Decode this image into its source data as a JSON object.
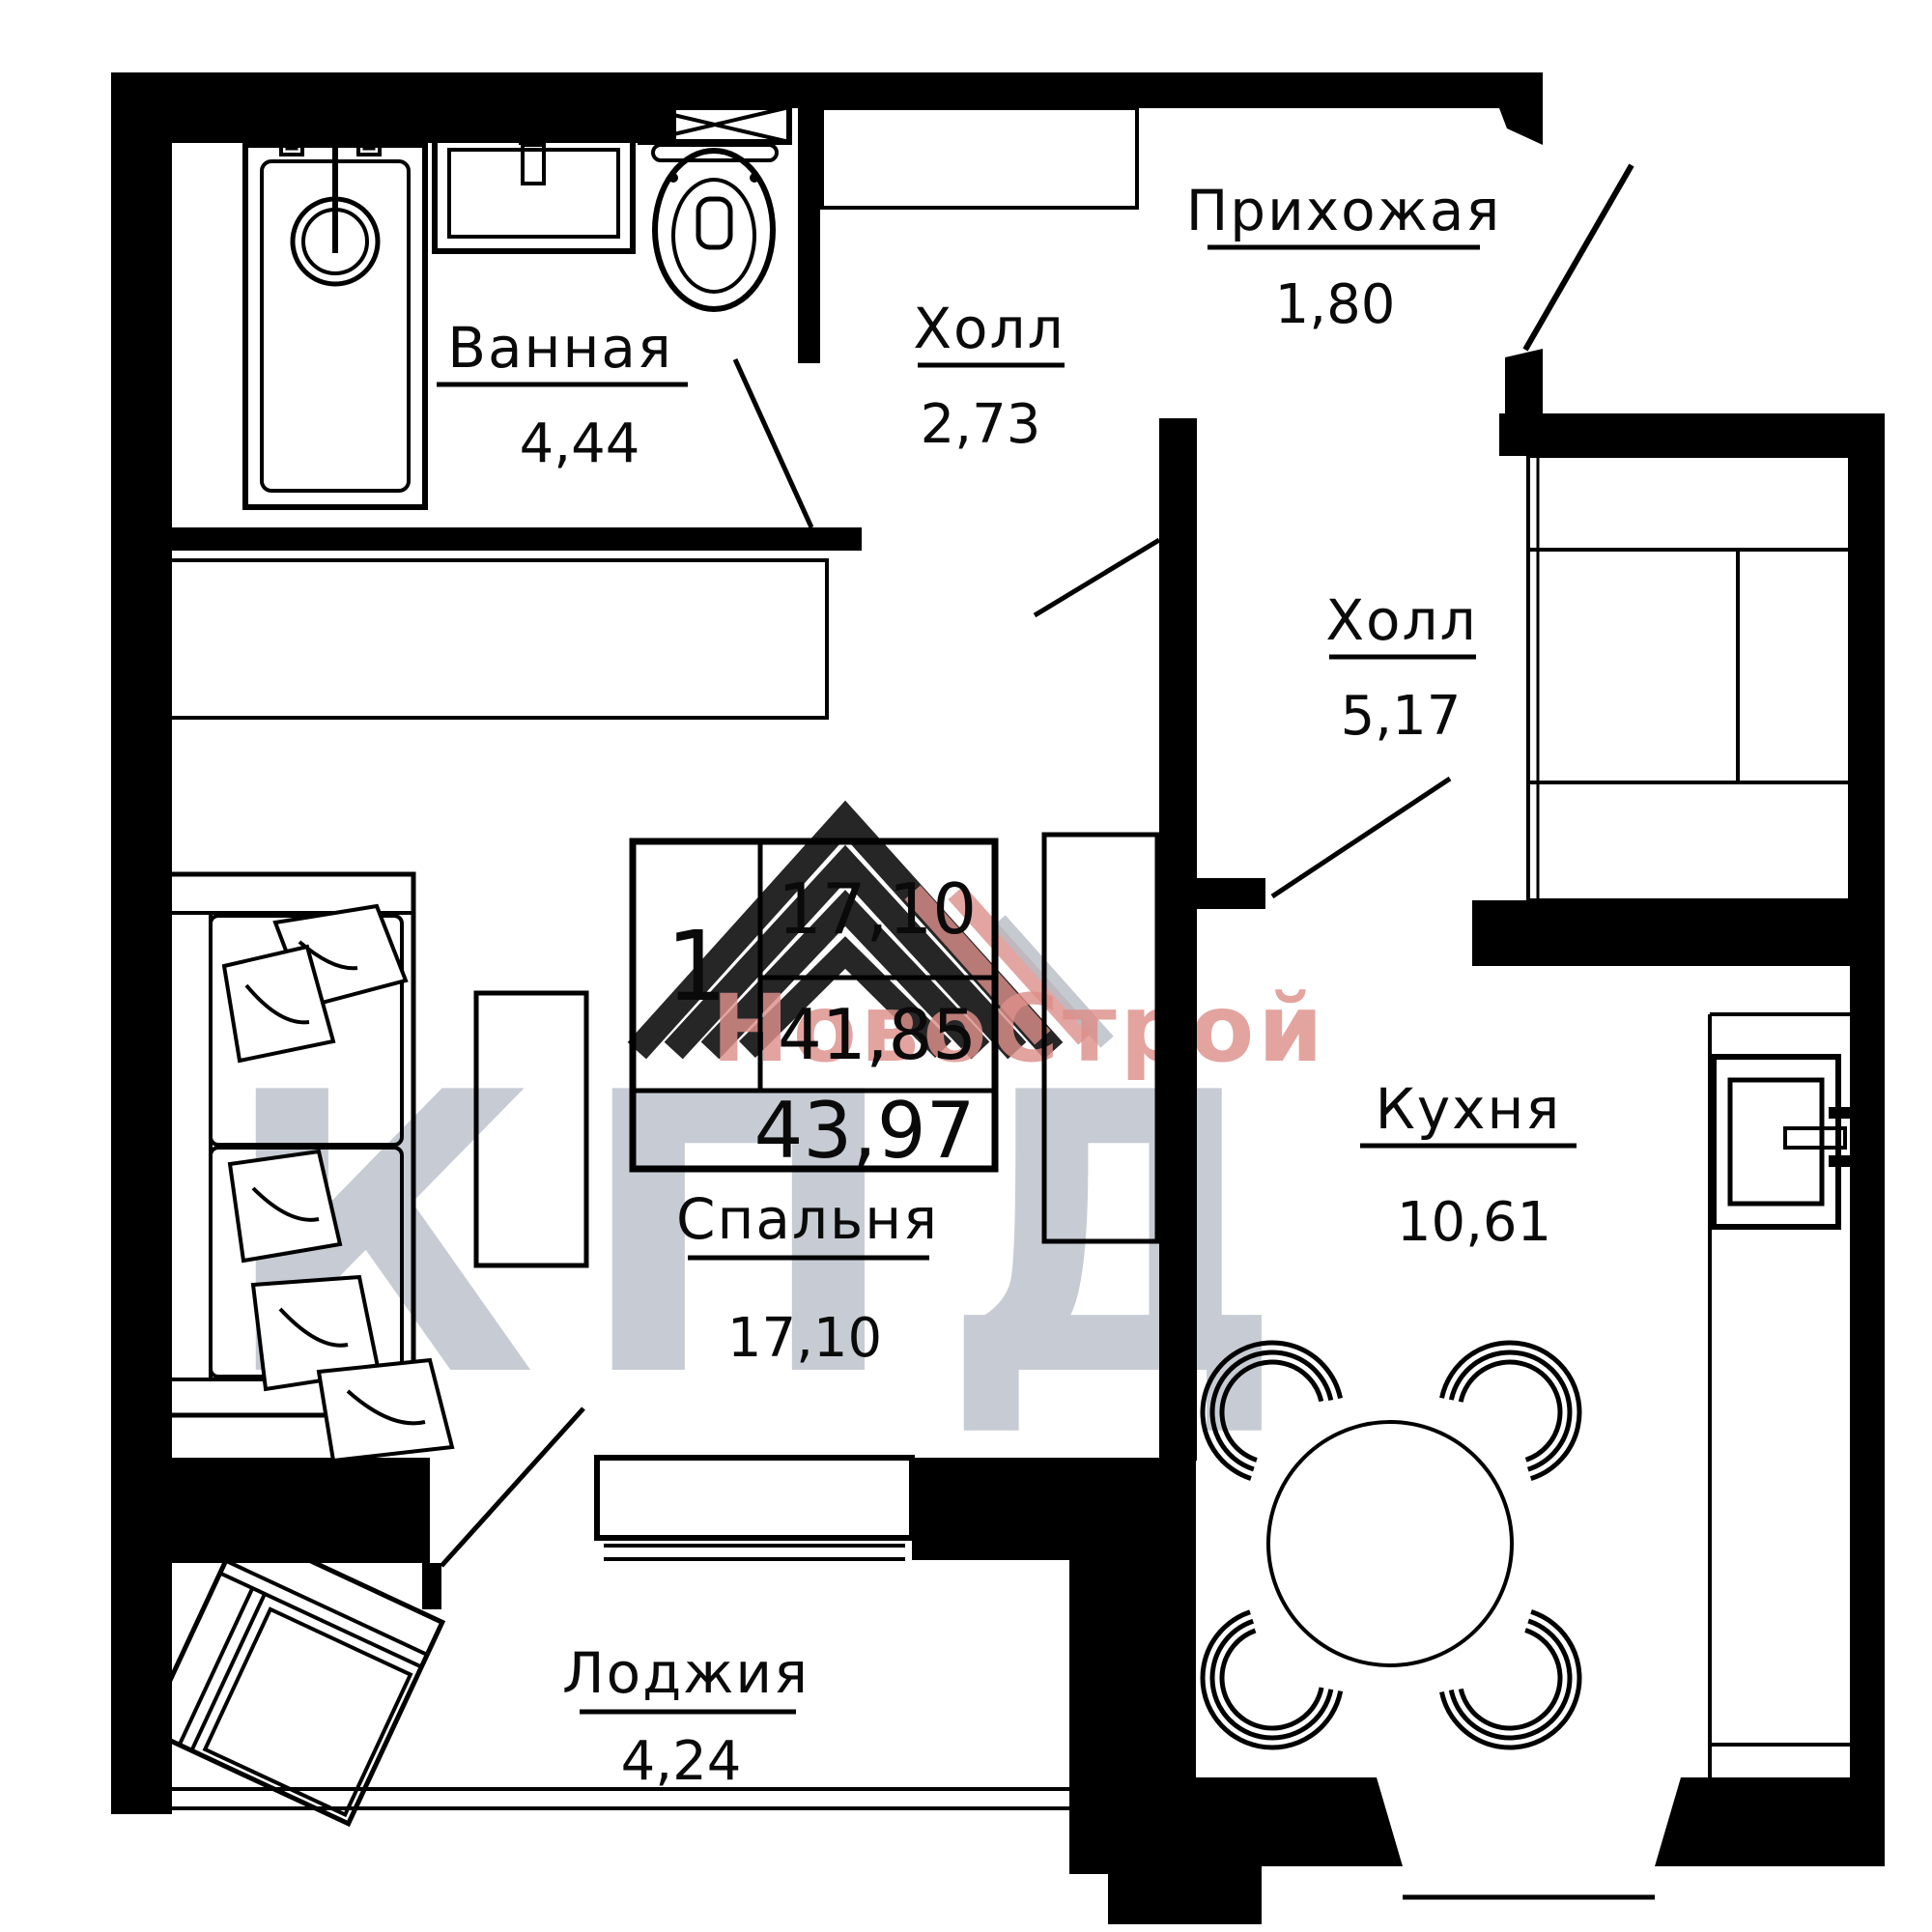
{
  "plan": {
    "rooms": {
      "bathroom": {
        "name": "Ванная",
        "area": "4,44"
      },
      "hall_small": {
        "name": "Холл",
        "area": "2,73"
      },
      "entry": {
        "name": "Прихожая",
        "area": "1,80"
      },
      "hall_big": {
        "name": "Холл",
        "area": "5,17"
      },
      "kitchen": {
        "name": "Кухня",
        "area": "10,61"
      },
      "bedroom": {
        "name": "Спальня",
        "area": "17,10"
      },
      "loggia": {
        "name": "Лоджия",
        "area": "4,24"
      }
    },
    "info_table": {
      "rooms_count": "1",
      "living_area": "17,10",
      "area_no_loggia": "41,85",
      "total_area": "43,97"
    },
    "watermark": {
      "brand": "НовоСтрой",
      "logo": "КПД"
    },
    "colors": {
      "walls": "#000000",
      "watermark_gray": "#b5bcc6",
      "watermark_red": "#dd8f8a"
    }
  }
}
